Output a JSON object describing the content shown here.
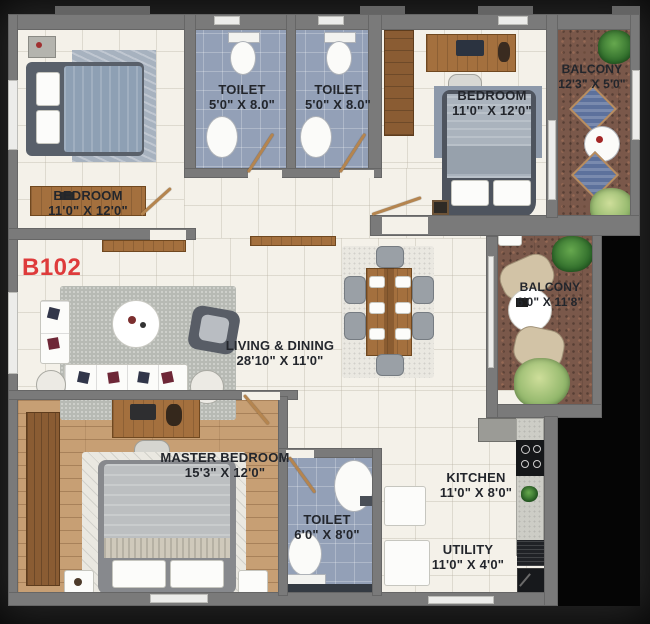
{
  "unit": {
    "label": "B102"
  },
  "rooms": {
    "bedroom_tl": {
      "name": "BEDROOM",
      "dims": "11'0\" X 12'0\""
    },
    "toilet_1": {
      "name": "TOILET",
      "dims": "5'0\" X 8.0\""
    },
    "toilet_2": {
      "name": "TOILET",
      "dims": "5'0\" X 8.0\""
    },
    "bedroom_tr": {
      "name": "BEDROOM",
      "dims": "11'0\" X 12'0\""
    },
    "balcony_top": {
      "name": "BALCONY",
      "dims": "12'3\" X 5'0\""
    },
    "living_dining": {
      "name": "LIVING & DINING",
      "dims": "28'10\" X 11'0\""
    },
    "balcony_right": {
      "name": "BALCONY",
      "dims": "6'0\" X 11'8\""
    },
    "master_bedroom": {
      "name": "MASTER BEDROOM",
      "dims": "15'3\" X 12'0\""
    },
    "toilet_3": {
      "name": "TOILET",
      "dims": "6'0\" X 8'0\""
    },
    "kitchen": {
      "name": "KITCHEN",
      "dims": "11'0\" X 8'0\""
    },
    "utility": {
      "name": "UTILITY",
      "dims": "11'0\" X 4'0\""
    }
  },
  "colors": {
    "unit_accent_red": "#de3b3b",
    "wall_gray": "#7a7a7a",
    "floor_cream": "#f4f1e9",
    "floor_tile_blue": "#93a0b7",
    "floor_balcony_rust": "#7a584a",
    "floor_wood": "#c79f74",
    "label_text": "#23262c"
  }
}
